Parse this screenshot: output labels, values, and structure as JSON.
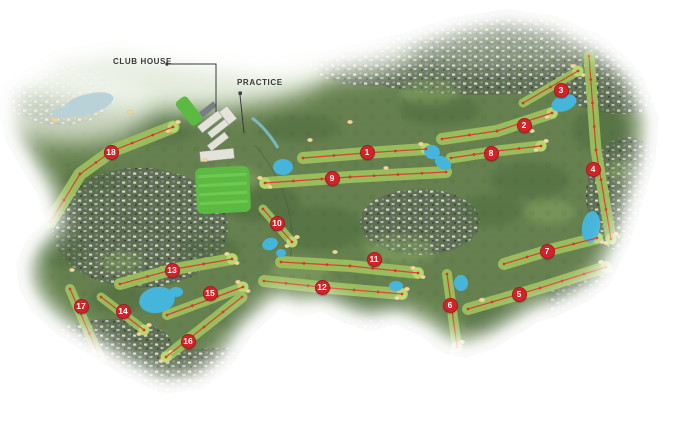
{
  "map": {
    "type": "golf-course-aerial-map",
    "labels": {
      "club_house": "CLUB HOUSE",
      "practice": "PRACTICE"
    },
    "colors": {
      "marker_red": "#d2232a",
      "line_red": "#d8362b",
      "water": "#45b5dc",
      "water_pale": "#b9d2d8",
      "fairway": "#9cbf5d",
      "green": "#b7d76f",
      "land": "#66814f",
      "forest": "#4a673b",
      "residential": "#5f6f52",
      "sand": "#ecd7a0",
      "practice_green": "#5cba43",
      "label_text": "#3a3a3a"
    },
    "holes": [
      {
        "number": "1",
        "marker": {
          "x": 367,
          "y": 152
        },
        "line": [
          [
            303,
            158
          ],
          [
            365,
            153
          ],
          [
            426,
            149
          ]
        ],
        "w": 12
      },
      {
        "number": "2",
        "marker": {
          "x": 524,
          "y": 125
        },
        "line": [
          [
            442,
            139
          ],
          [
            497,
            131
          ],
          [
            552,
            113
          ]
        ],
        "w": 12
      },
      {
        "number": "3",
        "marker": {
          "x": 561,
          "y": 90
        },
        "line": [
          [
            523,
            103
          ],
          [
            578,
            71
          ]
        ],
        "w": 9
      },
      {
        "number": "4",
        "marker": {
          "x": 593,
          "y": 169
        },
        "line": [
          [
            589,
            56
          ],
          [
            596,
            150
          ],
          [
            611,
            239
          ]
        ],
        "w": 11
      },
      {
        "number": "5",
        "marker": {
          "x": 519,
          "y": 294
        },
        "line": [
          [
            468,
            309
          ],
          [
            540,
            288
          ],
          [
            606,
            267
          ]
        ],
        "w": 12
      },
      {
        "number": "6",
        "marker": {
          "x": 450,
          "y": 305
        },
        "line": [
          [
            447,
            274
          ],
          [
            452,
            310
          ],
          [
            457,
            347
          ]
        ],
        "w": 10
      },
      {
        "number": "7",
        "marker": {
          "x": 547,
          "y": 251
        },
        "line": [
          [
            504,
            264
          ],
          [
            550,
            250
          ],
          [
            597,
            238
          ]
        ],
        "w": 12
      },
      {
        "number": "8",
        "marker": {
          "x": 491,
          "y": 153
        },
        "line": [
          [
            451,
            158
          ],
          [
            497,
            151
          ],
          [
            541,
            146
          ]
        ],
        "w": 11
      },
      {
        "number": "9",
        "marker": {
          "x": 332,
          "y": 178
        },
        "line": [
          [
            446,
            172
          ],
          [
            350,
            177
          ],
          [
            265,
            183
          ]
        ],
        "w": 12
      },
      {
        "number": "10",
        "marker": {
          "x": 277,
          "y": 223
        },
        "line": [
          [
            263,
            209
          ],
          [
            292,
            242
          ]
        ],
        "w": 9
      },
      {
        "number": "11",
        "marker": {
          "x": 374,
          "y": 259
        },
        "line": [
          [
            281,
            262
          ],
          [
            350,
            266
          ],
          [
            418,
            273
          ]
        ],
        "w": 12
      },
      {
        "number": "12",
        "marker": {
          "x": 322,
          "y": 287
        },
        "line": [
          [
            264,
            281
          ],
          [
            330,
            288
          ],
          [
            402,
            294
          ]
        ],
        "w": 12
      },
      {
        "number": "13",
        "marker": {
          "x": 172,
          "y": 270
        },
        "line": [
          [
            120,
            284
          ],
          [
            175,
            269
          ],
          [
            232,
            259
          ]
        ],
        "w": 12
      },
      {
        "number": "14",
        "marker": {
          "x": 123,
          "y": 311
        },
        "line": [
          [
            101,
            297
          ],
          [
            144,
            330
          ]
        ],
        "w": 9
      },
      {
        "number": "15",
        "marker": {
          "x": 210,
          "y": 293
        },
        "line": [
          [
            167,
            315
          ],
          [
            243,
            287
          ]
        ],
        "w": 10
      },
      {
        "number": "16",
        "marker": {
          "x": 188,
          "y": 341
        },
        "line": [
          [
            242,
            297
          ],
          [
            166,
            357
          ]
        ],
        "w": 11
      },
      {
        "number": "17",
        "marker": {
          "x": 81,
          "y": 306
        },
        "line": [
          [
            70,
            289
          ],
          [
            99,
            356
          ]
        ],
        "w": 10
      },
      {
        "number": "18",
        "marker": {
          "x": 111,
          "y": 152
        },
        "line": [
          [
            50,
            222
          ],
          [
            64,
            200
          ],
          [
            80,
            174
          ],
          [
            112,
            151
          ],
          [
            173,
            127
          ]
        ],
        "w": 13
      }
    ]
  }
}
